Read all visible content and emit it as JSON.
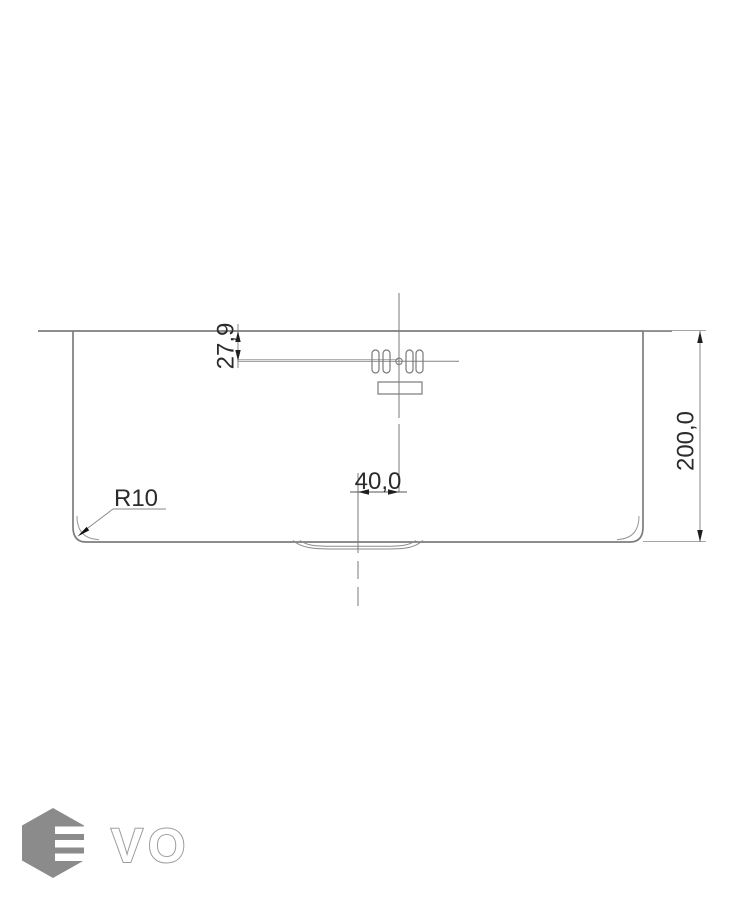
{
  "drawing": {
    "kind": "sink-front-section-technical-drawing",
    "dimension_labels": {
      "overflow_offset": "27,9",
      "bowl_height": "200,0",
      "drain_offset": "40,0",
      "corner_radius": "R10"
    },
    "logo": {
      "brand": "EVO",
      "outlined_letters": "VO"
    },
    "colors": {
      "background": "#ffffff",
      "line_gray": "#7d7d7d",
      "thin_line_gray": "#999999",
      "text_dark": "#2b2b2b",
      "arrow_dark": "#1f1f1f",
      "logo_gray": "#8b8b8b",
      "logo_outline_gray": "#9c9c9c"
    }
  }
}
